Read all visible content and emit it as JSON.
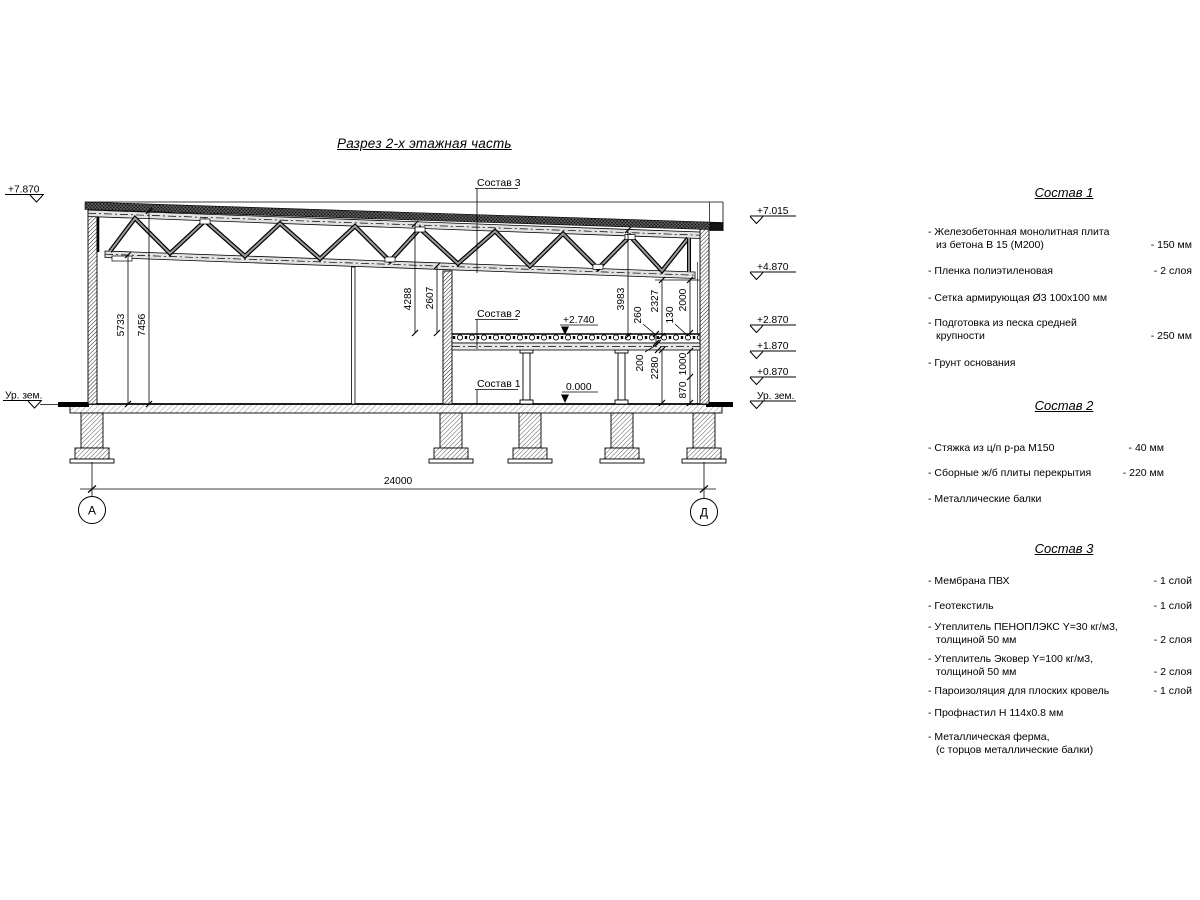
{
  "title": "Разрез 2-х этажная часть",
  "drawing": {
    "elev_left": [
      "+7.870",
      "Ур. зем."
    ],
    "elev_right": [
      "+7.015",
      "+4.870",
      "+2.870",
      "+1.870",
      "+0.870",
      "Ур. зем."
    ],
    "inner_levels": [
      "+2.740",
      "0.000"
    ],
    "leaders": [
      "Состав 3",
      "Состав 2",
      "Состав 1"
    ],
    "dims": {
      "h7456": "7456",
      "h5733": "5733",
      "h4288": "4288",
      "h2607": "2607",
      "h3983": "3983",
      "h260": "260",
      "h2327": "2327",
      "h130": "130",
      "h2000": "2000",
      "h200": "200",
      "h2280": "2280",
      "h1000": "1000",
      "h870": "870",
      "span": "24000"
    },
    "axes": [
      "А",
      "Д"
    ]
  },
  "panel": {
    "s1": {
      "heading": "Состав 1",
      "items": [
        {
          "name": "- Железобетонная  монолитная плита",
          "name2": "из бетона В 15 (М200)",
          "value": "- 150 мм"
        },
        {
          "name": "- Пленка полиэтиленовая",
          "value": "-  2 слоя"
        },
        {
          "name": "- Сетка армирующая Ø3 100x100 мм"
        },
        {
          "name": "- Подготовка из песка средней",
          "name2": "крупности",
          "value": "- 250 мм"
        },
        {
          "name": "- Грунт основания"
        }
      ]
    },
    "s2": {
      "heading": "Состав 2",
      "items": [
        {
          "name": "- Стяжка из ц/п р-ра М150",
          "value": "- 40 мм"
        },
        {
          "name": "- Сборные ж/б плиты перекрытия",
          "value": "- 220 мм"
        },
        {
          "name": "- Металлические балки"
        }
      ]
    },
    "s3": {
      "heading": "Состав 3",
      "items": [
        {
          "name": "- Мембрана ПВХ",
          "value": "- 1 слой"
        },
        {
          "name": "- Геотекстиль",
          "value": "- 1 слой"
        },
        {
          "name": "- Утеплитель ПЕНОПЛЭКС Y=30 кг/м3,",
          "name2": "толщиной 50 мм",
          "value": "- 2 слоя"
        },
        {
          "name": "- Утеплитель Эковер Y=100 кг/м3,",
          "name2": "толщиной 50 мм",
          "value": "- 2 слоя"
        },
        {
          "name": "- Пароизоляция для плоских кровель",
          "value": "- 1 слой"
        },
        {
          "name": "- Профнастил Н 114x0.8 мм"
        },
        {
          "name": "- Металлическая ферма,",
          "name2": "(с торцов металлические балки)"
        }
      ]
    }
  }
}
